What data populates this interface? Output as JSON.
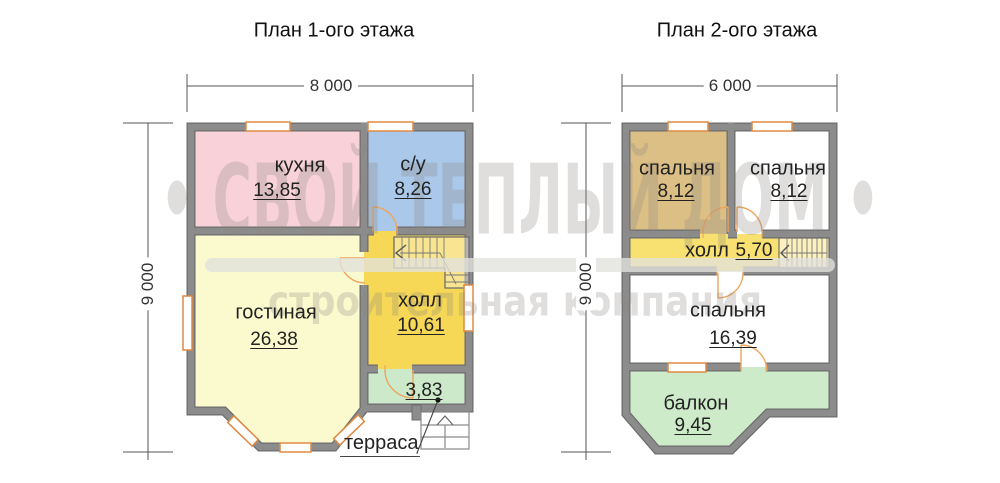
{
  "watermark": {
    "bullet_title": "• СВОЙ ТЕПЛЫЙ ДОМ •",
    "subtitle": "строительная компания"
  },
  "plan1": {
    "title": "План 1-ого этажа",
    "width_label": "8 000",
    "height_label": "9 000",
    "rooms": {
      "kitchen": {
        "name": "кухня",
        "area": "13,85"
      },
      "bathroom": {
        "name": "с/у",
        "area": "8,26"
      },
      "living": {
        "name": "гостиная",
        "area": "26,38"
      },
      "hall": {
        "name": "холл",
        "area": "10,61"
      },
      "terrace": {
        "name": "терраса",
        "area": "3,83"
      }
    }
  },
  "plan2": {
    "title": "План 2-ого этажа",
    "width_label": "6 000",
    "height_label": "9 000",
    "rooms": {
      "bedroom1": {
        "name": "спальня",
        "area": "8,12"
      },
      "bedroom2": {
        "name": "спальня",
        "area": "8,12"
      },
      "hall": {
        "name": "холл",
        "area": "5,70"
      },
      "bedroom3": {
        "name": "спальня",
        "area": "16,39"
      },
      "balcony": {
        "name": "балкон",
        "area": "9,45"
      }
    }
  },
  "colors": {
    "wall": "#8c8c8c",
    "wall_edge": "#6d6d6d",
    "kitchen": "#f8d2d8",
    "bathroom": "#aac8e9",
    "living": "#fbface",
    "hall1": "#f6d856",
    "terrace": "#cce9ca",
    "bedroom_tan": "#dcbf85",
    "hall2": "#f8e170",
    "balcony": "#cdeac9",
    "window_frame": "#e08a42",
    "door_arc": "#eda65f",
    "dimension_line": "#555555"
  }
}
